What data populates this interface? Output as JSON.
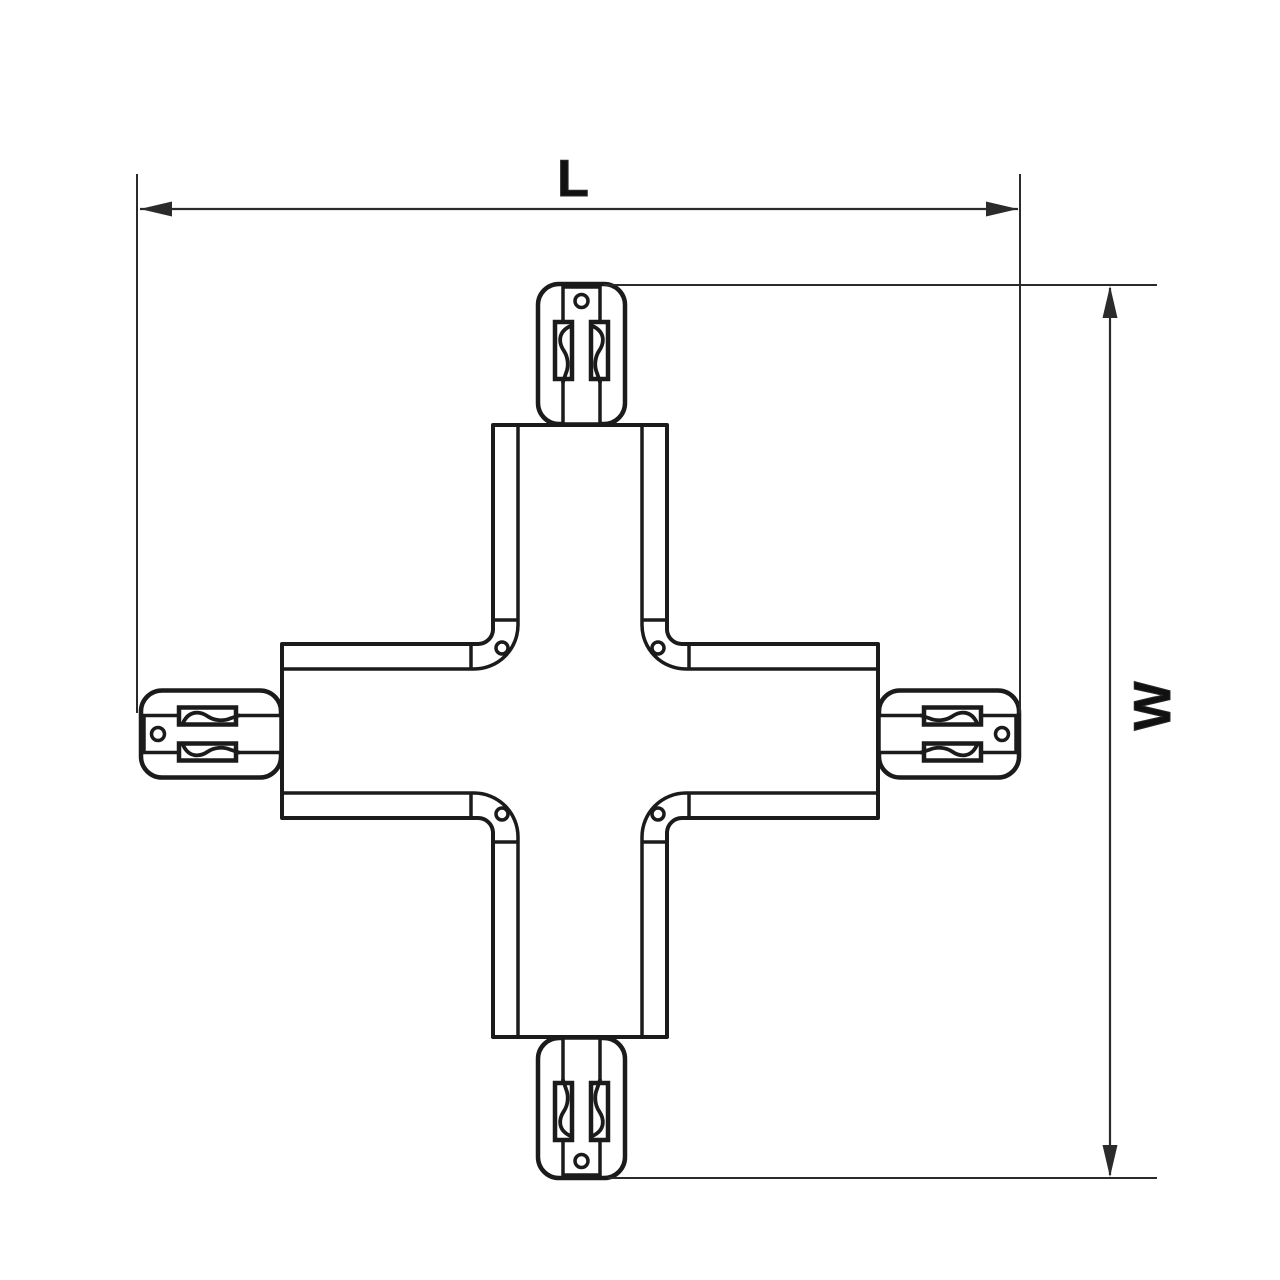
{
  "diagram": {
    "kind": "technical-drawing",
    "subject": "x-shaped-track-connector",
    "labels": {
      "length": "L",
      "width": "W"
    },
    "colors": {
      "background": "#ffffff",
      "outline": "#1b1b1b",
      "dimension": "#2b2b2b"
    }
  }
}
